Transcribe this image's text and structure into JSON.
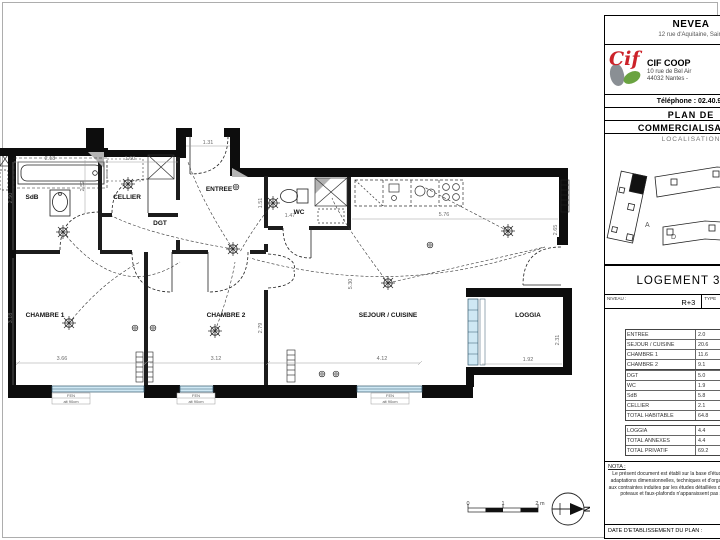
{
  "colors": {
    "accent_red": "#cc2229",
    "accent_green": "#6aa341",
    "window_blue": "#cfe8f4"
  },
  "title_block": {
    "company_name": "NEVEA",
    "company_address": "12 rue d'Aquitaine, Saint",
    "logo_text": "Cif",
    "firm_name": "CIF COOP",
    "firm_address1": "10 rue de Bel Air",
    "firm_address2": "44032 Nantes -",
    "phone": "Téléphone : 02.40.99",
    "plan_title_line1": "PLAN DE",
    "plan_title_line2": "COMMERCIALISATION",
    "localisation_label": "LOCALISATION",
    "buildings": [
      "A",
      "B",
      "D"
    ],
    "logement_title": "LOGEMENT 30 (B",
    "niveau_label": "NIVEAU :",
    "niveau_value": "R+3",
    "type_label": "TYPE",
    "area_table": {
      "rows": [
        {
          "name": "ENTREE",
          "value": "2.0"
        },
        {
          "name": "SEJOUR / CUISINE",
          "value": "20.6"
        },
        {
          "name": "CHAMBRE 1",
          "value": "11.6"
        },
        {
          "name": "CHAMBRE 2",
          "value": "9.1"
        },
        {
          "name": "DGT",
          "value": "5.0"
        },
        {
          "name": "WC",
          "value": "1.9"
        },
        {
          "name": "SdB",
          "value": "5.8"
        },
        {
          "name": "CELLIER",
          "value": "2.1"
        },
        {
          "name": "TOTAL HABITABLE",
          "value": "64.8"
        }
      ],
      "annex_rows": [
        {
          "name": "LOGGIA",
          "value": "4.4"
        },
        {
          "name": "TOTAL ANNEXES",
          "value": "4.4"
        },
        {
          "name": "TOTAL PRIVATIF",
          "value": "69.2"
        }
      ]
    },
    "nota_label": "NOTA :",
    "nota_text": "Le présent document est établi sur la base d'études et pourra subir des adaptations dimensionnelles, techniques et d'organisation pour répondre aux contraintes induites par les études détaillées d'exécution. Les poutres, poteaux et faux-plafonds n'apparaissent pas systématiquement.",
    "date_label": "DATE D'ETABLISSEMENT DU PLAN :"
  },
  "plan": {
    "room_labels": {
      "sdb": "SdB",
      "cellier": "CELLIER",
      "dgt": "DGT",
      "entree": "ENTREE",
      "wc": "WC",
      "chambre1": "CHAMBRE 1",
      "chambre2": "CHAMBRE 2",
      "sejour": "SEJOUR / CUISINE",
      "loggia": "LOGGIA"
    },
    "dims": {
      "d218": "2.18",
      "d160": "1.60",
      "d131": "1.31",
      "d250": "2.50",
      "d252": "2.52",
      "d147": "1.47",
      "d151": "1.51",
      "d576": "5.76",
      "d265": "2.65",
      "d318": "3.18",
      "d366": "3.66",
      "d312": "3.12",
      "d279": "2.79",
      "d530": "5.30",
      "d412": "4.12",
      "d192": "1.92",
      "d231": "2.31"
    },
    "window_tag": {
      "line1": "FEN",
      "line2": "alt 90cm"
    },
    "scale": {
      "t0": "0",
      "t1": "1",
      "t2": "2 m"
    },
    "north": "N"
  }
}
